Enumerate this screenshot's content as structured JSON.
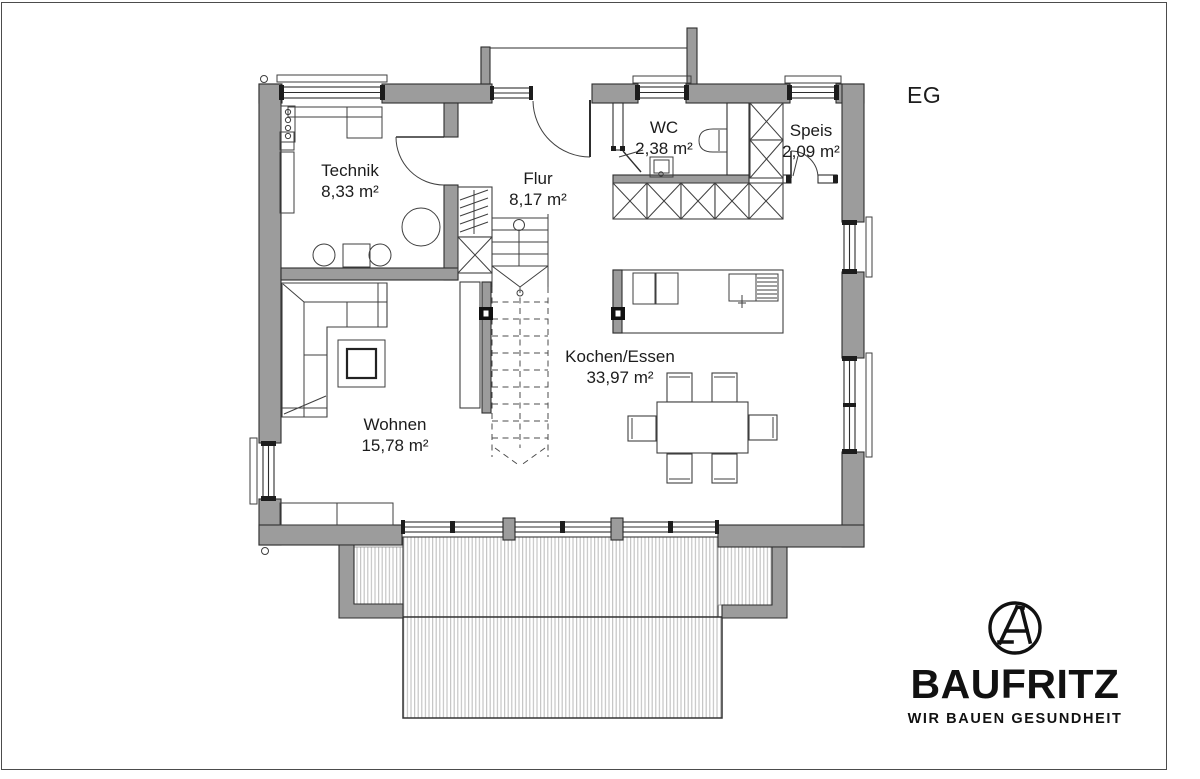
{
  "page": {
    "floor_label": "EG"
  },
  "rooms": [
    {
      "id": "technik",
      "name": "Technik",
      "area": "8,33 m²"
    },
    {
      "id": "flur",
      "name": "Flur",
      "area": "8,17 m²"
    },
    {
      "id": "wc",
      "name": "WC",
      "area": "2,38 m²"
    },
    {
      "id": "speis",
      "name": "Speis",
      "area": "2,09 m²"
    },
    {
      "id": "kochen_essen",
      "name": "Kochen/Essen",
      "area": "33,97 m²"
    },
    {
      "id": "wohnen",
      "name": "Wohnen",
      "area": "15,78 m²"
    }
  ],
  "branding": {
    "name": "BAUFRITZ",
    "tagline": "WIR BAUEN GESUNDHEIT",
    "logo_icon": "compass-a-monogram-icon"
  },
  "colors": {
    "wall_fill": "#9c9c9c",
    "outline": "#2e2e2e",
    "deck_stripe": "#c5c5c5",
    "text": "#1c1c1c",
    "logo": "#111111"
  }
}
